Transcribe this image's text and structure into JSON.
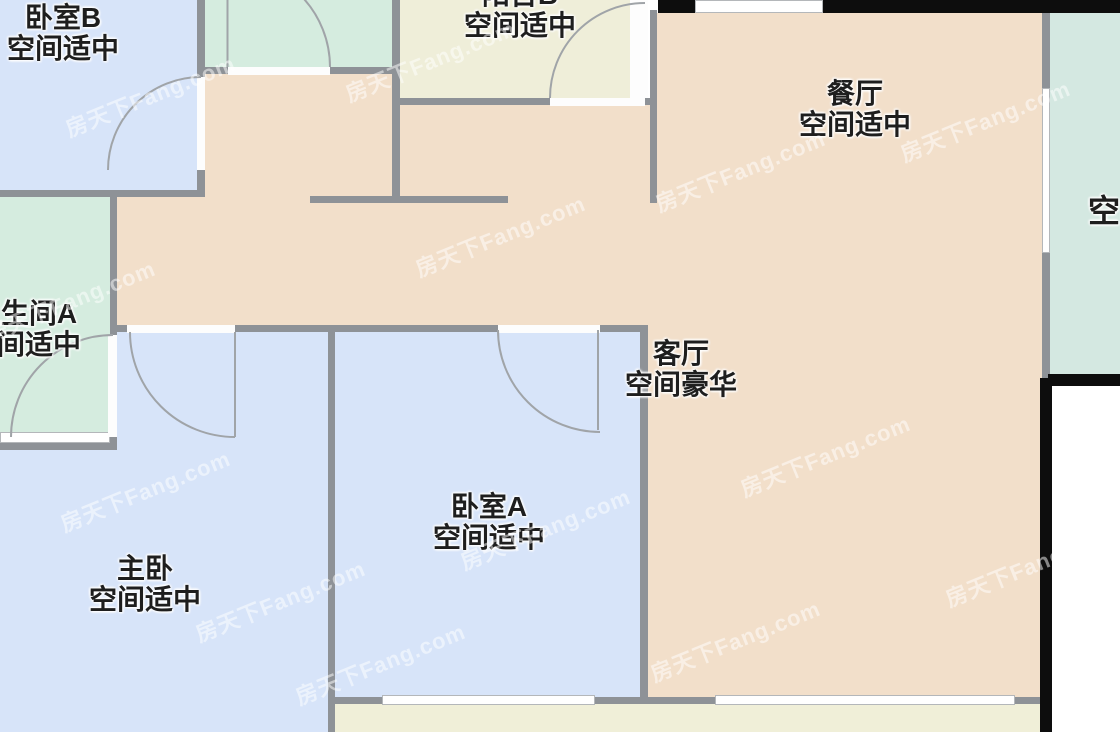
{
  "watermark": {
    "text": "房天下Fang.com"
  },
  "palette": {
    "wall_gray": "#8e9297",
    "wall_black": "#0d0d0d",
    "room_blue": "#d7e4f9",
    "room_peach": "#f2dfca",
    "room_mint": "#d5ecdf",
    "room_mint2": "#d4e8e1",
    "room_yellow": "#efeed9",
    "room_yellow2": "#f0efd8",
    "arc_gray": "#a0a4a8",
    "label_color": "#1e1e1e"
  },
  "rooms": {
    "bedroom_b": {
      "name": "卧室B",
      "note": "空间适中"
    },
    "balcony_b": {
      "name": "阳台B",
      "note": "空间适中"
    },
    "dining": {
      "name": "餐厅",
      "note": "空间适中"
    },
    "living": {
      "name": "客厅",
      "note": "空间豪华"
    },
    "bathroom_a": {
      "name": "卫生间A",
      "note": "空间适中"
    },
    "master": {
      "name": "主卧",
      "note": "空间适中"
    },
    "bedroom_a": {
      "name": "卧室A",
      "note": "空间适中"
    },
    "right_room": {
      "note": "空间适中"
    }
  }
}
